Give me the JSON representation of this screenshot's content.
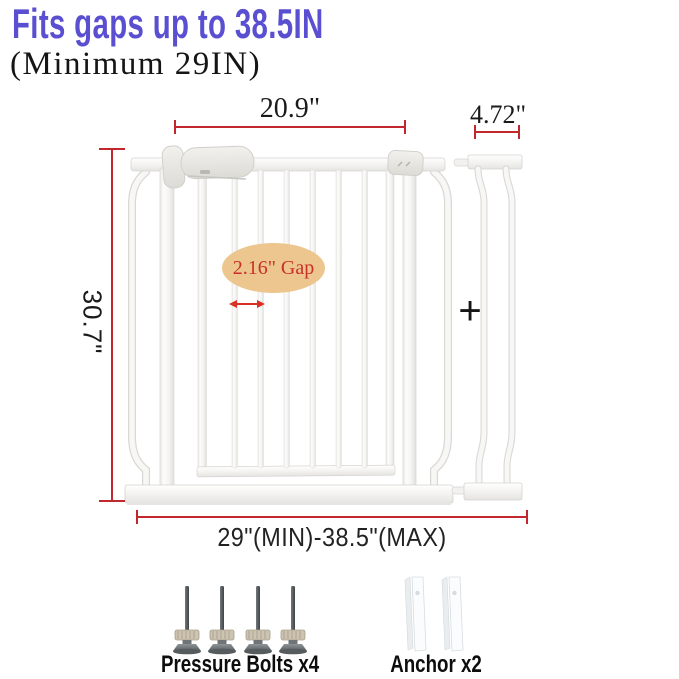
{
  "title": "Fits gaps up to 38.5IN",
  "subtitle": "(Minimum 29IN)",
  "measurements": {
    "gate_width": "20.9\"",
    "extension_width": "4.72\"",
    "gate_height": "30.7\"",
    "gap_label": "2.16\" Gap",
    "width_range": "29\"(MIN)-38.5\"(MAX)",
    "plus": "+"
  },
  "parts": {
    "pressure_bolts_label": "Pressure Bolts x4",
    "anchors_label": "Anchor x2"
  },
  "colors": {
    "title": "#5a4fd0",
    "measurement_red": "#c1272d",
    "gap_ellipse_fill": "#ecc68e",
    "gap_text": "#c92f28",
    "text_black": "#1a1a1a"
  },
  "illustrations": {
    "gate": "white-pressure-mounted-safety-gate",
    "extension": "gate-extension-panel",
    "pressure_bolt": "pressure-bolt",
    "anchor": "wall-anchor"
  }
}
